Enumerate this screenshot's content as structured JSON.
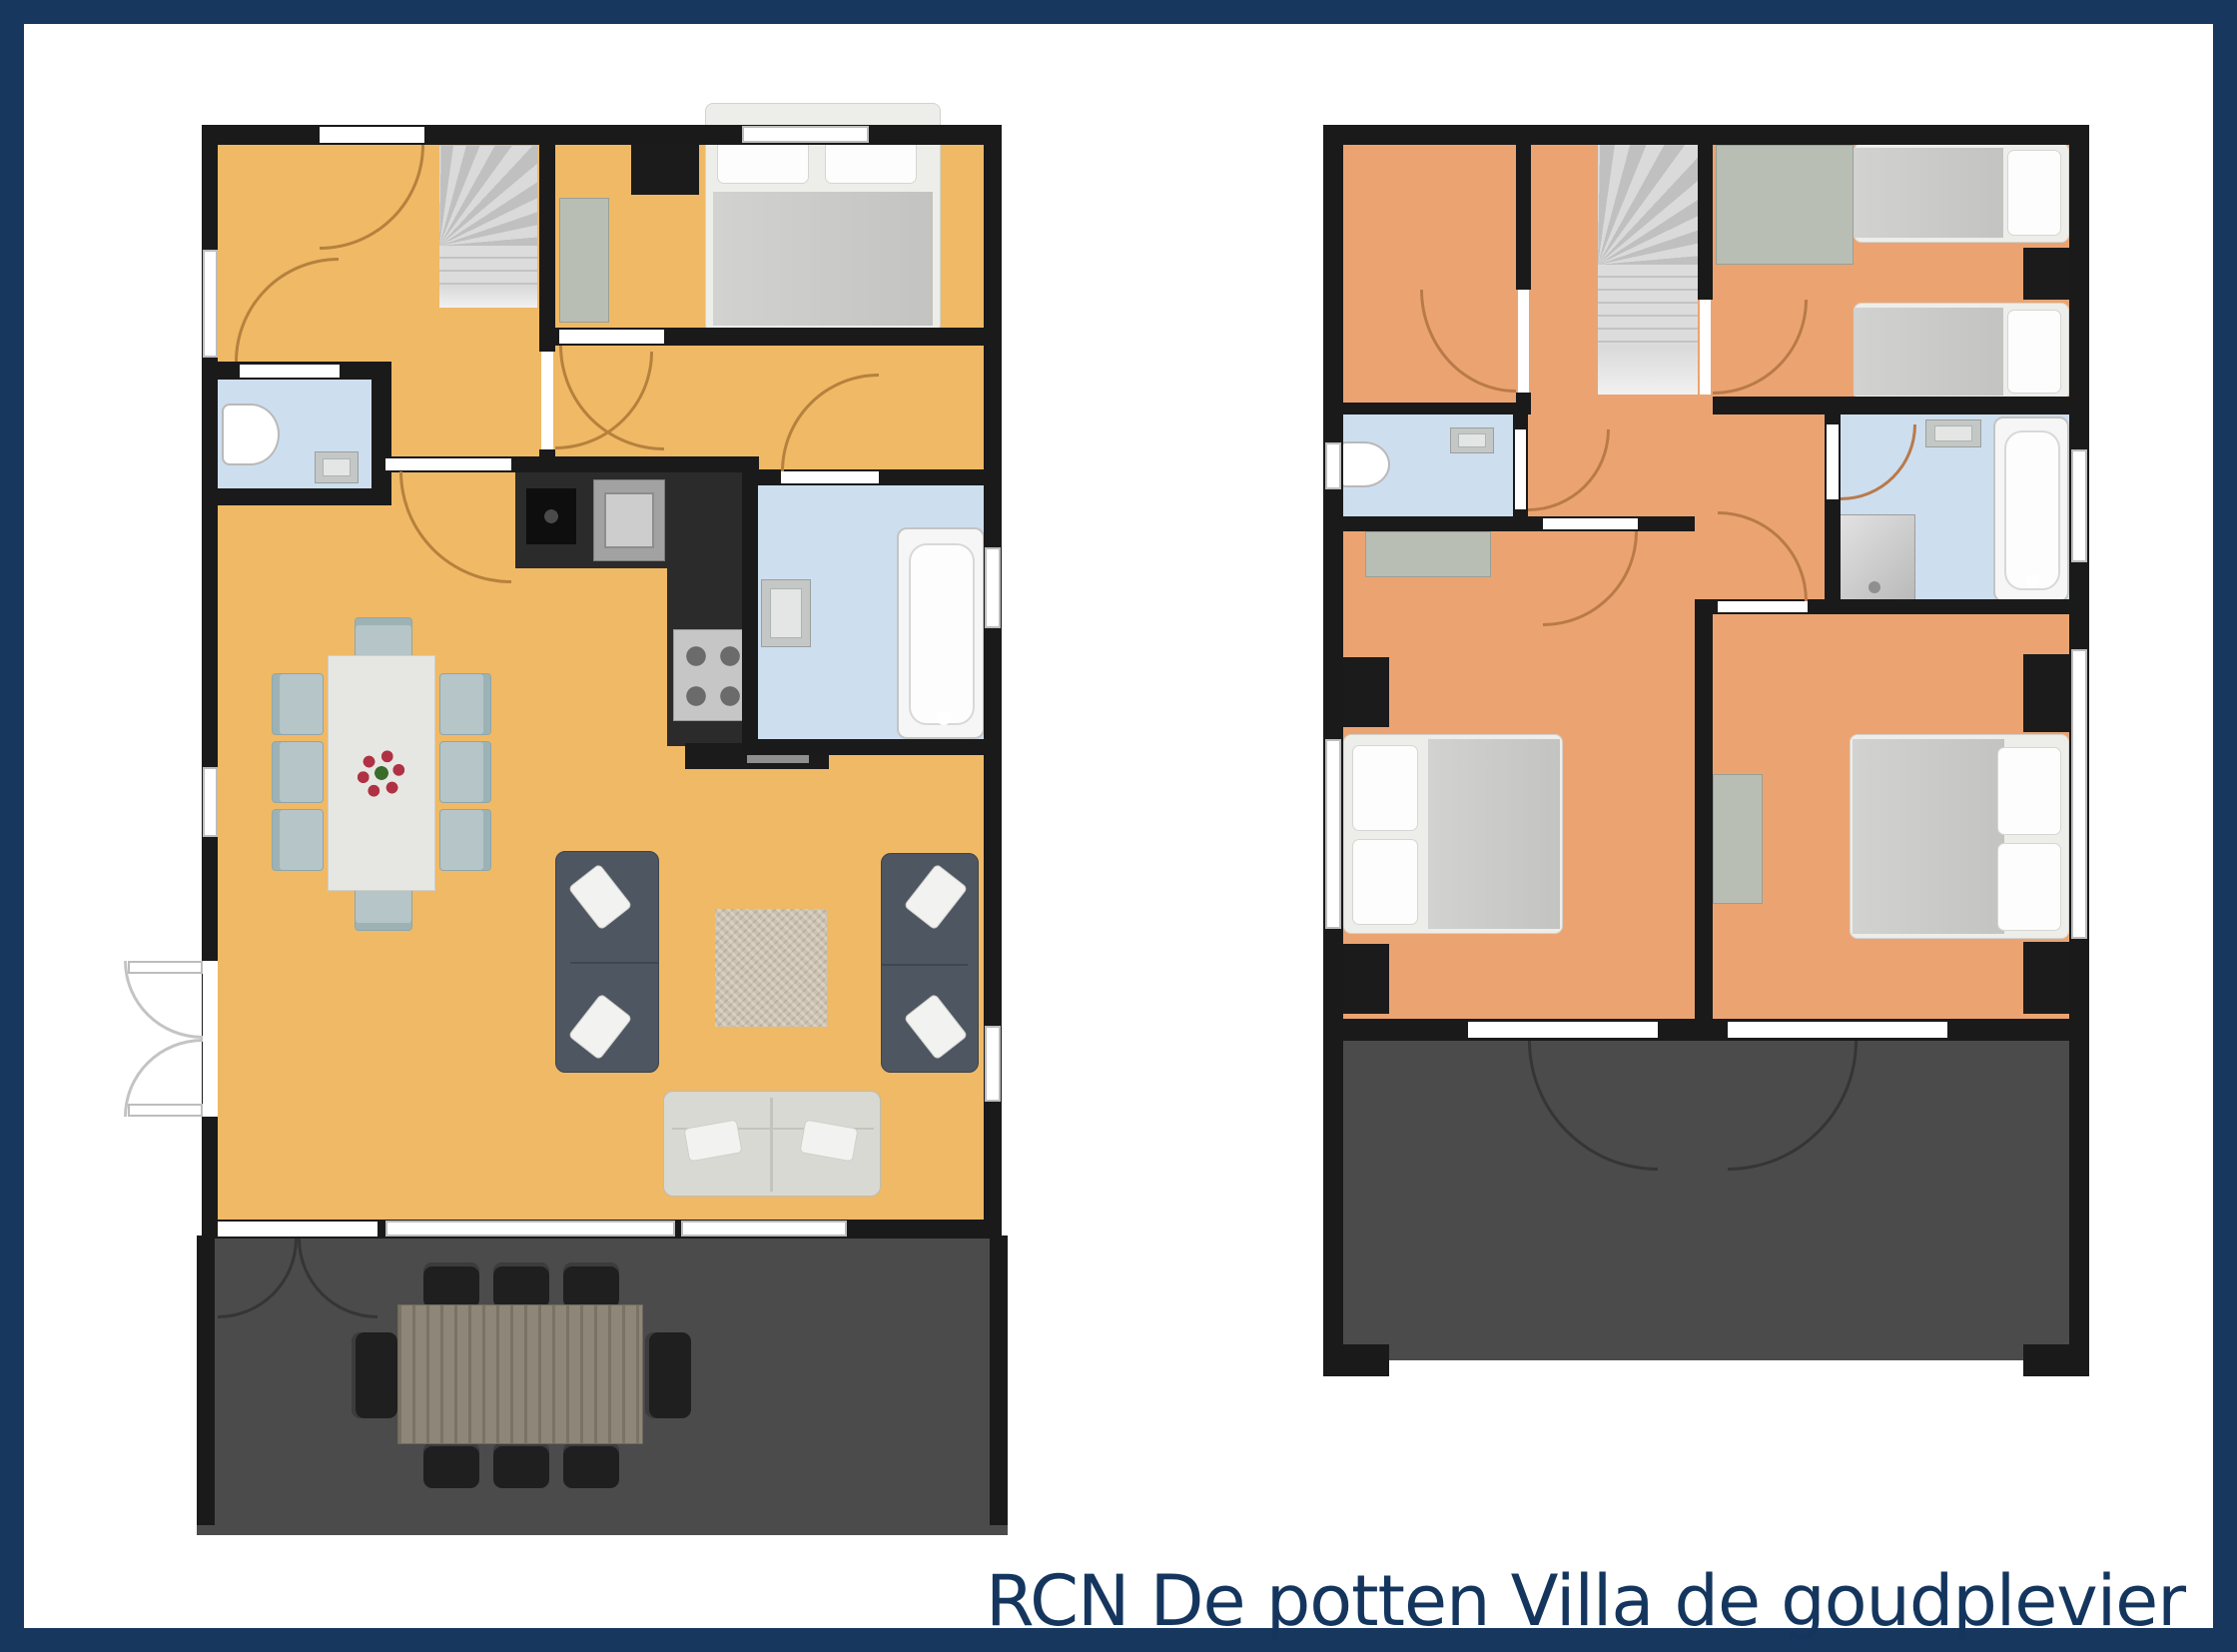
{
  "title": {
    "text": "RCN De potten Villa de goudplevier"
  },
  "colors": {
    "frame_border": "#17375f",
    "title_text": "#14365e",
    "ground_floor": "#f0b965",
    "upper_floor": "#eba471",
    "wet_room_floor": "#cddeef",
    "wall": "#1a1a1a",
    "terrace": "#4b4b4b",
    "door_arc_ground": "#b5813e",
    "door_arc_upper": "#b97a4a",
    "stairs": "#cccccc",
    "wardrobe": "#b9beb5",
    "bed_frame": "#ededea",
    "bed_blanket": "#c8c8c6",
    "sofa_dark": "#4e5661",
    "sofa_light": "#d9d9d4",
    "dining_chair": "#b5c5c8",
    "rug": "#cbc1b0",
    "kitchen_counter": "#2b2b2b",
    "outdoor_table": "#8e8678",
    "outdoor_chair": "#1f1f1f",
    "flower_red": "#b03143",
    "flower_green": "#3a6b2a"
  }
}
